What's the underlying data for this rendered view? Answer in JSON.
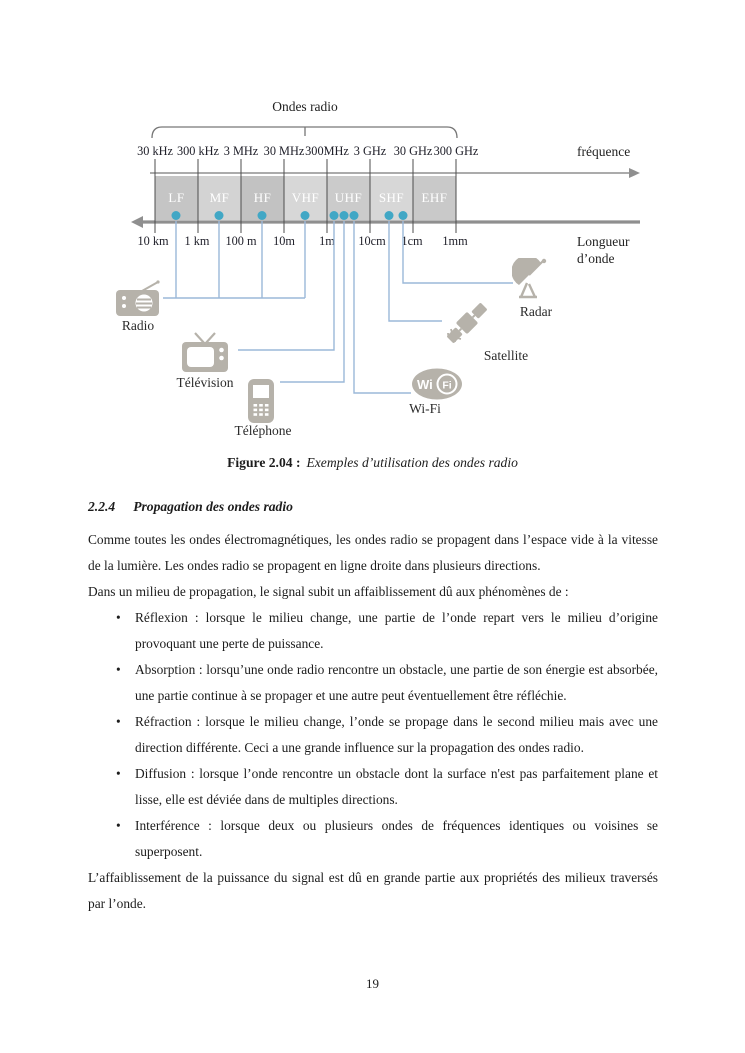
{
  "figure": {
    "title": "Ondes radio",
    "frequency_axis_label": "fréquence",
    "wavelength_axis_label_line1": "Longueur",
    "wavelength_axis_label_line2": "d’onde",
    "frequency_ticks": [
      "30 kHz",
      "300 kHz",
      "3 MHz",
      "30 MHz",
      "300MHz",
      "3 GHz",
      "30 GHz",
      "300 GHz"
    ],
    "wavelength_ticks": [
      "10 km",
      "1 km",
      "100 m",
      "10m",
      "1m",
      "10cm",
      "1cm",
      "1mm"
    ],
    "bands": [
      {
        "label": "LF",
        "color": "#c5c5c5"
      },
      {
        "label": "MF",
        "color": "#d3d3d3"
      },
      {
        "label": "HF",
        "color": "#c2c2c2"
      },
      {
        "label": "VHF",
        "color": "#d7d7d7"
      },
      {
        "label": "UHF",
        "color": "#cbcbcb"
      },
      {
        "label": "SHF",
        "color": "#d7d7d7"
      },
      {
        "label": "EHF",
        "color": "#c9c9c9"
      }
    ],
    "devices": [
      {
        "label": "Radio"
      },
      {
        "label": "Télévision"
      },
      {
        "label": "Téléphone"
      },
      {
        "label": "Wi-Fi"
      },
      {
        "label": "Satellite"
      },
      {
        "label": "Radar"
      }
    ],
    "wifi_logo": {
      "part1": "Wi",
      "part2": "Fi"
    },
    "colors": {
      "dot_blue": "#41a7c5",
      "connector_blue": "#9bb8d9",
      "axis_gray": "#8f8f8f",
      "icon_gray": "#b6b2aa",
      "band_label_text": "#ffffff"
    }
  },
  "caption": {
    "label": "Figure 2.04 :",
    "text": "Exemples d’utilisation des ondes radio"
  },
  "section": {
    "number": "2.2.4",
    "title": "Propagation des ondes radio"
  },
  "paragraphs": {
    "p1": "Comme toutes les ondes électromagnétiques, les ondes radio se propagent dans l’espace vide à la vitesse de la lumière. Les ondes radio se propagent en ligne droite dans plusieurs directions.",
    "p2": "Dans un milieu de propagation, le signal subit un affaiblissement dû aux phénomènes de :",
    "p3": "L’affaiblissement de la puissance du signal est dû en grande partie aux propriétés des milieux traversés par l’onde."
  },
  "list": {
    "marker": "•",
    "items": [
      {
        "text": "Réflexion : lorsque le milieu change, une partie de l’onde repart vers le milieu d’origine provoquant une perte de puissance."
      },
      {
        "text": "Absorption : lorsqu’une onde radio rencontre un obstacle, une partie de son énergie est absorbée, une partie continue à se propager et une autre peut éventuellement être réfléchie."
      },
      {
        "text": "Réfraction : lorsque le milieu change, l’onde se propage dans le second milieu mais avec une direction différente. Ceci a une grande influence sur la propagation des ondes radio."
      },
      {
        "text": "Diffusion : lorsque l’onde rencontre un obstacle dont la surface n'est pas parfaitement plane et lisse, elle est déviée dans de multiples directions."
      },
      {
        "text": "Interférence : lorsque deux ou plusieurs ondes de fréquences identiques ou voisines se superposent."
      }
    ]
  },
  "page": {
    "number": "19"
  }
}
